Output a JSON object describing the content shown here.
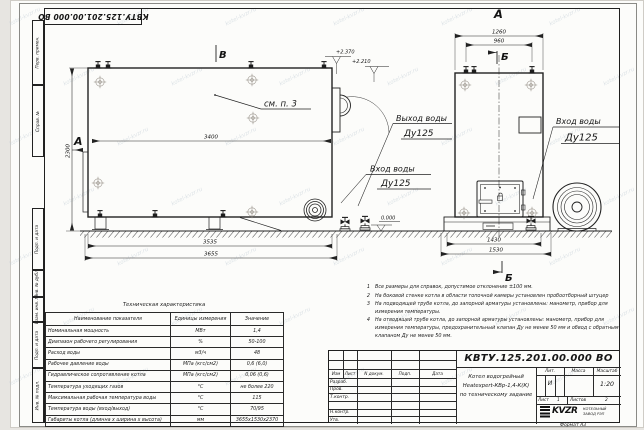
{
  "page": {
    "format_label": "Формат  А3"
  },
  "doc": {
    "number": "КВТУ.125.201.00.000  ВО"
  },
  "stamps": {
    "left": [
      "Перв. примен.",
      "Справ. №",
      "Подп. и дата",
      "Инв. № дубл.",
      "Взам. инв. №",
      "Подп. и дата",
      "Инв. № подл."
    ]
  },
  "drawing": {
    "front": {
      "view_mark": "А",
      "sect_mark": "В",
      "see_note": "см. п. 3",
      "dim_top": "3400",
      "dim_height": "2300",
      "dim_base": "3535",
      "dim_total": "3655",
      "level_high": "+2.370",
      "level_mid": "+2.210",
      "level_zero": "0.000"
    },
    "side": {
      "view_label": "А",
      "sect_mark_top": "Б",
      "sect_mark_bottom": "Б",
      "dim_outer": "1260",
      "dim_inner": "960",
      "dim_base": "1430",
      "dim_total": "1530"
    },
    "callout_outlet": {
      "title": "Выход воды",
      "dn": "Ду125"
    },
    "callout_inlet_mid": {
      "title": "Вход воды",
      "dn": "Ду125"
    },
    "callout_inlet_right": {
      "title": "Вход воды",
      "dn": "Ду125"
    }
  },
  "notes": {
    "n1": {
      "num": "1",
      "text": "Все размеры для справок, допустимое отклонение ±100 мм."
    },
    "n2": {
      "num": "2",
      "text": "На боковой стенке котла в области топочной камеры установлен пробоотборный штуцер"
    },
    "n3": {
      "num": "3",
      "text": "На подводящей трубе котла, до запорной арматуры установлены: манометр, прибор для измерения температуры."
    },
    "n4": {
      "num": "4",
      "text": "На отводящей трубе котла, до запорной арматуры установлены: манометр, прибор для измерения температуры, предохранительный клапан Ду не менее 50 мм и обвод с обратным клапаном Ду не менее 50 мм."
    }
  },
  "spec": {
    "title": "Техническая характеристика",
    "col_name": "Наименование показателя",
    "col_units": "Единицы измерения",
    "col_value": "Значение",
    "rows": [
      [
        "Номинальная мощность",
        "МВт",
        "1,4"
      ],
      [
        "Диапазон рабочего регулирования",
        "%",
        "50-100"
      ],
      [
        "Расход воды",
        "м3/ч",
        "48"
      ],
      [
        "Рабочее давление воды",
        "МПа (кгс/см2)",
        "0,6 (6,0)"
      ],
      [
        "Гидравлическое сопротивление котла",
        "МПа (кгс/см2)",
        "0,06 (0,6)"
      ],
      [
        "Температура уходящих газов",
        "°С",
        "не более 220"
      ],
      [
        "Максимальная рабочая температура воды",
        "°С",
        "115"
      ],
      [
        "Температура воды (вход/выход)",
        "°С",
        "70/95"
      ],
      [
        "Габариты котла (длинна х ширина х высота)",
        "мм",
        "3655х1530х2370"
      ]
    ]
  },
  "tb": {
    "number": "КВТУ.125.201.00.000  ВО",
    "name1": "Котел водогрейный",
    "name2": "Heatexpert-КВр-1,4-К(К)",
    "name3": "по техническому задание",
    "h_izm": "Изм",
    "h_list": "Лист",
    "h_doc": "N докум.",
    "h_sign": "Подп.",
    "h_date": "Дата",
    "r1": "Разраб.",
    "r2": "Пров.",
    "r3": "Т.контр.",
    "r4": "Н.контр.",
    "r5": "Утв.",
    "lit": "Лит.",
    "mass": "Масса",
    "scale": "Масштаб",
    "lit_v": "И",
    "scale_v": "1:20",
    "sheet": "Лист",
    "sheet_v": "1",
    "sheets": "Листов",
    "sheets_v": "2",
    "logo": "KVZR",
    "logo_cap1": "КОТЕЛЬНЫЙ",
    "logo_cap2": "ЗАВОД РЭП"
  },
  "watermark": {
    "text": "kotel-kvzr.ru"
  }
}
